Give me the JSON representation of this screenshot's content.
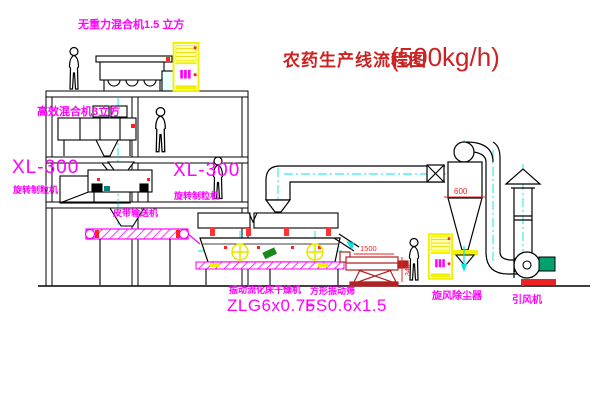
{
  "title": {
    "text": "农药生产线流程图",
    "capacity": "(500kg/h)"
  },
  "equipment_labels": {
    "mixer_top": "无重力混合机1.5 立方",
    "mixer_mid": "高效混合机3立方",
    "granulator_left": {
      "model": "XL-300",
      "name": "旋转制粒机"
    },
    "granulator_right": {
      "model": "XL-300",
      "name": "旋转制粒机"
    },
    "belt_conveyor": "皮带输送机",
    "dryer": {
      "name": "振动流化床干燥机",
      "model": "ZLG6x0.75"
    },
    "sieve": {
      "name": "方形振动筛",
      "model": "FS0.6x1.5"
    },
    "cyclone": "旋风除尘器",
    "fan": "引风机"
  },
  "dimensions": {
    "cyclone_width": "600",
    "sieve_length": "1500",
    "sieve_height": "345"
  },
  "colors": {
    "label": "#ff00ff",
    "title": "#cc2222",
    "centerline": "#00e5e5",
    "cabinet": "#f0f000",
    "dimension": "#ee2222",
    "sieve_line": "#b22222",
    "motor_green": "#00a070"
  }
}
